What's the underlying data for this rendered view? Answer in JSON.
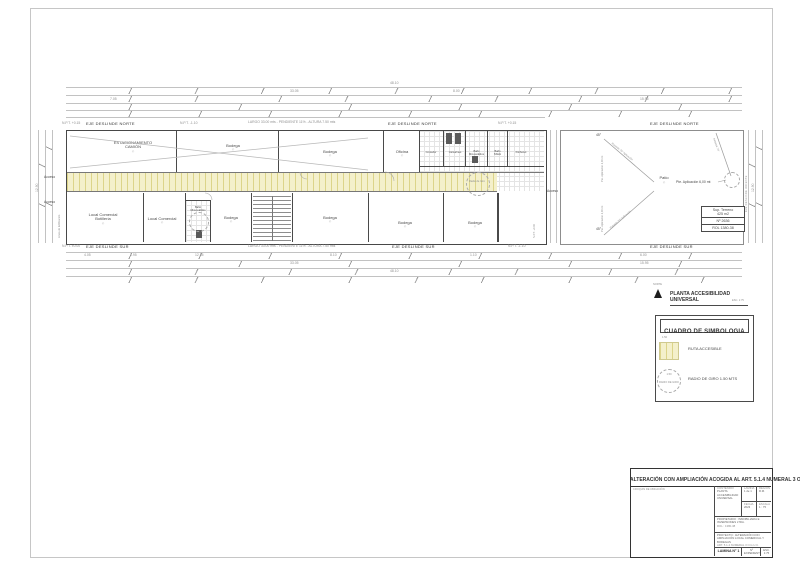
{
  "colors": {
    "line_dark": "#4a4a4a",
    "line_dim": "#c2c2c2",
    "route_fill": "#f4f0cb",
    "route_stripe": "#dcd489"
  },
  "plan": {
    "eje_norte": "EJE DESLINDE NORTE",
    "eje_sur": "EJE DESLINDE SUR",
    "eje_oriente": "EJE DESLINDE ORIENTE",
    "ramp_note": "LARGO 33.00 mts - PENDIENTE 11% - ALTURA 7.50 mts",
    "npt": [
      "N.P.T. +0.15",
      "N.P.T. -1.10",
      "N.P.T. +0.15",
      "N.P.T. ±0.00",
      "N.P.T. -1.10"
    ],
    "access": "Acceso",
    "linea_edificacion": "Línea de Edificación",
    "porton_npt": "N.P.T. +0.00",
    "radio_giro": "Radio de Giro",
    "rooms": [
      {
        "name": "ESTACIONAMIENTO\nCAMIÓN"
      },
      {
        "name": "Bodega"
      },
      {
        "name": "Bodega"
      },
      {
        "name": "Oficina"
      },
      {
        "name": "Comedor"
      },
      {
        "name": "Camarines"
      },
      {
        "name": "Baño\nMinusválidos"
      },
      {
        "name": "Baño\nSSHH"
      },
      {
        "name": "Kitchenet"
      },
      {
        "name": "Local Comercial\nBotillería"
      },
      {
        "name": "Local Comercial"
      },
      {
        "name": "Baño\nMinusválidos"
      },
      {
        "name": "Bodega"
      },
      {
        "name": "Bodega"
      },
      {
        "name": "Bodega"
      },
      {
        "name": "Bodega"
      }
    ],
    "patio": {
      "label": "Patio",
      "angle_top": "45°",
      "angle_bottom": "45°",
      "pte_v1": "Pte. Aplicación 2,00 mt",
      "pte_v2": "Pte. Aplicación 2,00 mt",
      "pte_h": "Pte. Aplicación 6,00 mt",
      "rasante1": "Rasante 70° Aplicación",
      "rasante2": "Rasante 70° Aplicación",
      "rasante3": "Rasante 70°",
      "terreno1": "Sup. Terreno",
      "terreno2": "425 m2",
      "terreno3": "Nº 2636",
      "terreno4": "ROL 1380-38"
    }
  },
  "dims": {
    "top": [
      "7.05",
      "33.05",
      "8.00",
      "15.95",
      "48.10"
    ],
    "bottom": [
      "4.05",
      "1.95",
      "12.55",
      "8.10",
      "1.10",
      "6.00",
      "33.05",
      "15.95",
      "48.10"
    ],
    "left": "12.90",
    "right": "12.90"
  },
  "caption": {
    "norte": "NORTE",
    "title": "PLANTA ACCESIBILIDAD UNIVERSAL",
    "piso": "PISO 1",
    "escala": "ESC. 1:75"
  },
  "legend": {
    "title": "CUADRO DE SIMBOLOGIA",
    "ruta_dim": "1.50",
    "ruta_label": "RUTA ACCESIBLE",
    "radio_dim": "1.50",
    "radio_circle_text": "RADIO DE GIRO",
    "radio_label": "RADIO DE GIRO 1.50 MTS"
  },
  "titleblock": {
    "banner": "ALTERACIÓN CON AMPLIACIÓN ACOGIDA AL ART.  5.1.4 NUMERAL 3 O.G.U.C.",
    "croquis": "CROQUIS DE UBICACIÓN",
    "contenido_h": "CONTENIDO",
    "contenido_v": "PLANTA ACCESIBILIDAD UNIVERSAL",
    "lamina_h": "LAMINA",
    "lamina_v": "1 de 1",
    "region_h": "REGION",
    "region_v": "R.M.",
    "fecha_h": "FECHA",
    "fecha_v": "2023",
    "escala_h": "ESCALA",
    "escala_v": "1 : 75",
    "prop1": "PROPIETARIO : INMOBILIARIA E INVERSIONES LTDA.",
    "prop2": "ROL : 1380-38",
    "proy1": "PROYECTO : ALTERACIÓN CON AMPLIACIÓN LOCAL COMERCIAL Y BODEGAS",
    "proy2": "ART. 5.1.4 NUMERAL 3 O.G.U.C.",
    "lamina_n": "LAMINA N° 1",
    "expediente": "Nº EXPEDIENTE",
    "esc_small": "ESC. 1:75"
  }
}
